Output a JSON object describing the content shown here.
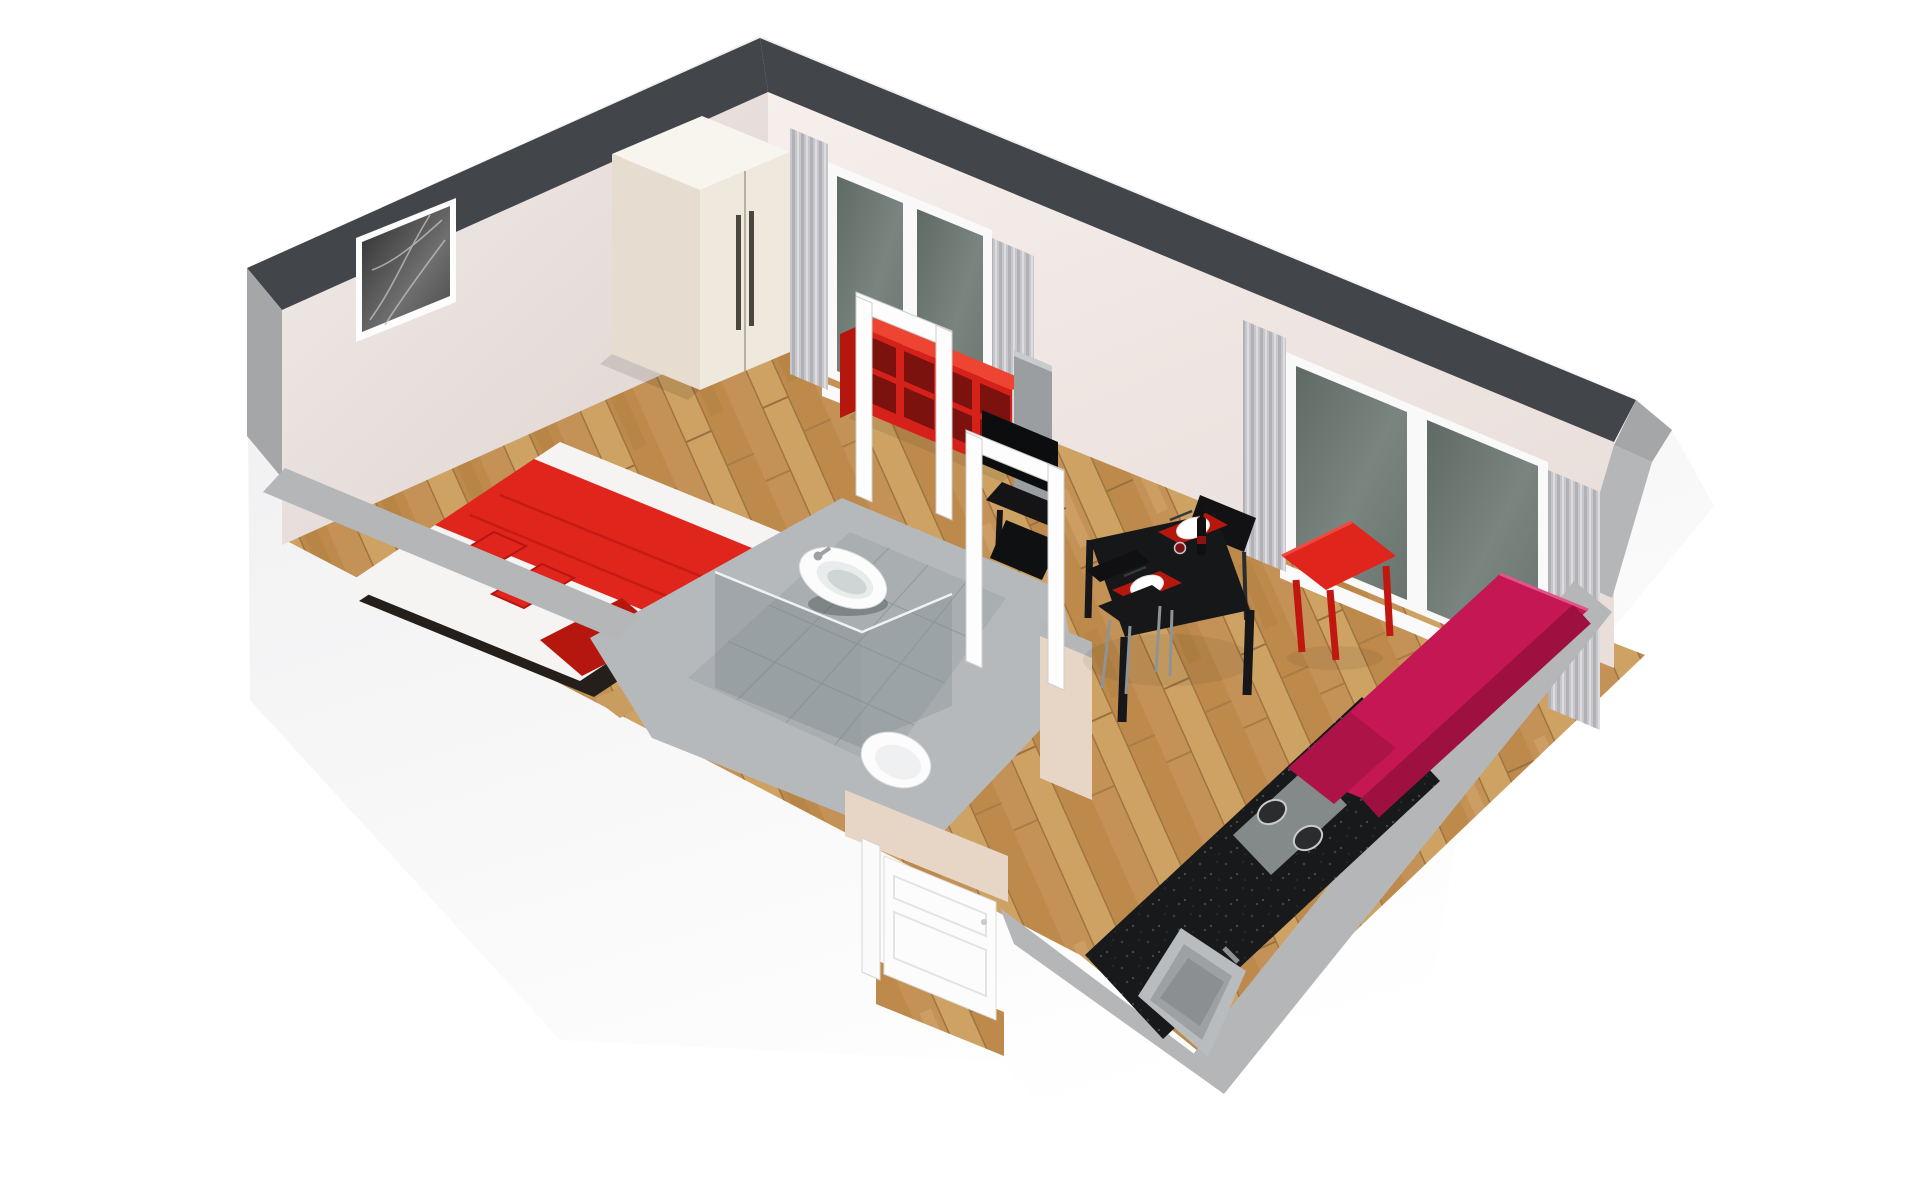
{
  "scene": {
    "type": "3d-floorplan-render",
    "title": "Studio apartment 3D floor plan (isometric cutaway)",
    "view": "top-down isometric, front walls cut low",
    "background": "#ffffff"
  },
  "palette": {
    "wall_cap": "#42454a",
    "wall_edge": "#a4a6a8",
    "wall_cut_top": "#b4b6b8",
    "wall_inner": "#f0e9e6",
    "wall_outer": "#f1f1f3",
    "floor_wood": "#c89a5e",
    "threshold_wood": "#c99c60",
    "tile": "#a9aeb0",
    "plateau": "#b6b9bb",
    "glass_window": "#6e7a72",
    "curtain": "#c7c6ca",
    "red": "#e0251c",
    "red_dark": "#b5170f",
    "shelf_red": "#d6211a",
    "shelf_red_top": "#ee4533",
    "shelf_hole": "#7c120e",
    "magenta": "#c41753",
    "magenta_dark": "#9e1040",
    "black": "#161719",
    "tv_black": "#0c0d0e",
    "granite": "#17191b",
    "white_fixture": "#fcfcfc",
    "beige": "#e7d6c5",
    "chrome": "#9da1a4",
    "picture_dark": "#3a3a3a"
  },
  "rooms": {
    "bedroom": {
      "name": "Bedroom",
      "floor": "oak parquet",
      "items": [
        {
          "item": "double bed",
          "colors": [
            "white",
            "red"
          ],
          "detail": "red blanket band, two red pillows, dark frame"
        },
        {
          "item": "wardrobe",
          "color": "cream",
          "detail": "two doors with long dark handles"
        },
        {
          "item": "wall picture",
          "style": "black and white photograph"
        },
        {
          "item": "window",
          "detail": "two panes, gray curtains both sides"
        }
      ]
    },
    "bathroom": {
      "name": "Bathroom",
      "floor": "gray tile",
      "items": [
        {
          "item": "wall-hung sink",
          "color": "white",
          "detail": "chrome faucet"
        },
        {
          "item": "toilet",
          "color": "white"
        },
        {
          "item": "shower",
          "detail": "glass corner enclosure"
        },
        {
          "item": "open door frames",
          "color": "white",
          "count": 2
        }
      ]
    },
    "living_dining": {
      "name": "Living / dining room",
      "floor": "oak parquet",
      "items": [
        {
          "item": "cube shelf",
          "color": "red",
          "detail": "2 rows x 4 cubbies"
        },
        {
          "item": "tv with stand",
          "color": "black",
          "detail": "mounted on gray half wall"
        },
        {
          "item": "dining table",
          "color": "black",
          "detail": "2 red placemats, 2 white plates, dark bottle, glass"
        },
        {
          "item": "chairs",
          "color": "black",
          "count": 2,
          "detail": "chrome legs"
        },
        {
          "item": "side stool",
          "color": "red"
        },
        {
          "item": "sofa / daybed",
          "color": "magenta"
        },
        {
          "item": "window",
          "detail": "two panes, gray curtains both sides"
        }
      ]
    },
    "kitchen": {
      "name": "Kitchenette",
      "items": [
        {
          "item": "counter",
          "color": "black granite",
          "detail": "runs along front-right wall"
        },
        {
          "item": "cooktop",
          "detail": "2 burners"
        },
        {
          "item": "sink",
          "color": "stainless"
        }
      ]
    },
    "entry": {
      "name": "Entry",
      "items": [
        {
          "item": "entry door",
          "color": "white",
          "detail": "panelled, shown open inward"
        },
        {
          "item": "threshold",
          "color": "wood"
        }
      ]
    }
  }
}
